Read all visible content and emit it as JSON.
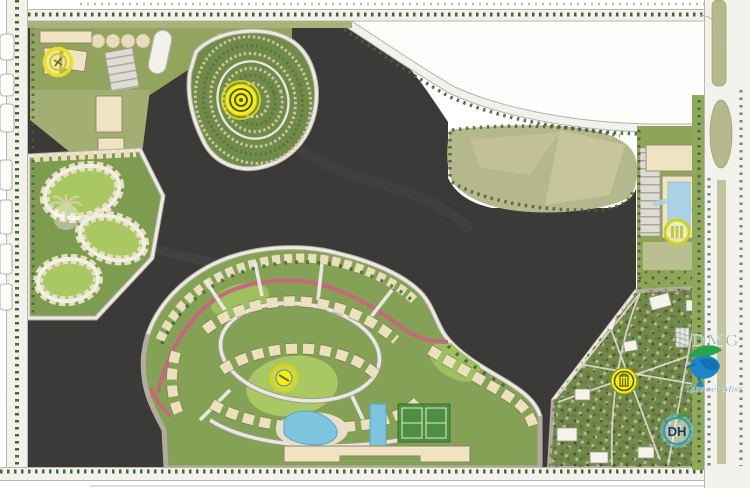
{
  "map": {
    "kind": "real-estate master plan illustration",
    "logos": {
      "dmg": {
        "label": "DMG"
      },
      "tatweer": {
        "label": "Tatweer Misr"
      },
      "dh": {
        "label": "DH"
      }
    },
    "markers": {
      "northwest_block": {
        "icon": "yellow-ring-marker"
      },
      "north_village": {
        "icon": "yellow-target-marker"
      },
      "west_village": {
        "icon": "palm-emblem"
      },
      "east_complex": {
        "icon": "yellow-ring-marker"
      },
      "central_village": {
        "icon": "yellow-dot-marker"
      },
      "southeast_village": {
        "icon": "yellow-gate-marker"
      }
    },
    "colors": {
      "dark_parcel": "#3b3a38",
      "road": "#f2f1ec",
      "road_casing": "#b5b3ab",
      "community_green": "#85a156",
      "dense_green": "#6e8c49",
      "lawn_green": "#a9c763",
      "olive_field": "#b5b88c",
      "building_cream": "#efe3c2",
      "pool_blue": "#7fc4dd",
      "glass_blue": "#aad4e6",
      "marker_yellow": "#f2ee1e",
      "pink_road": "#c4697d",
      "tree_green": "#46633a",
      "dmg_gray": "#98a2a8",
      "dh_teal": "#2a9db8",
      "bird_green": "#29a24e",
      "bird_blue": "#1e85c7"
    }
  }
}
